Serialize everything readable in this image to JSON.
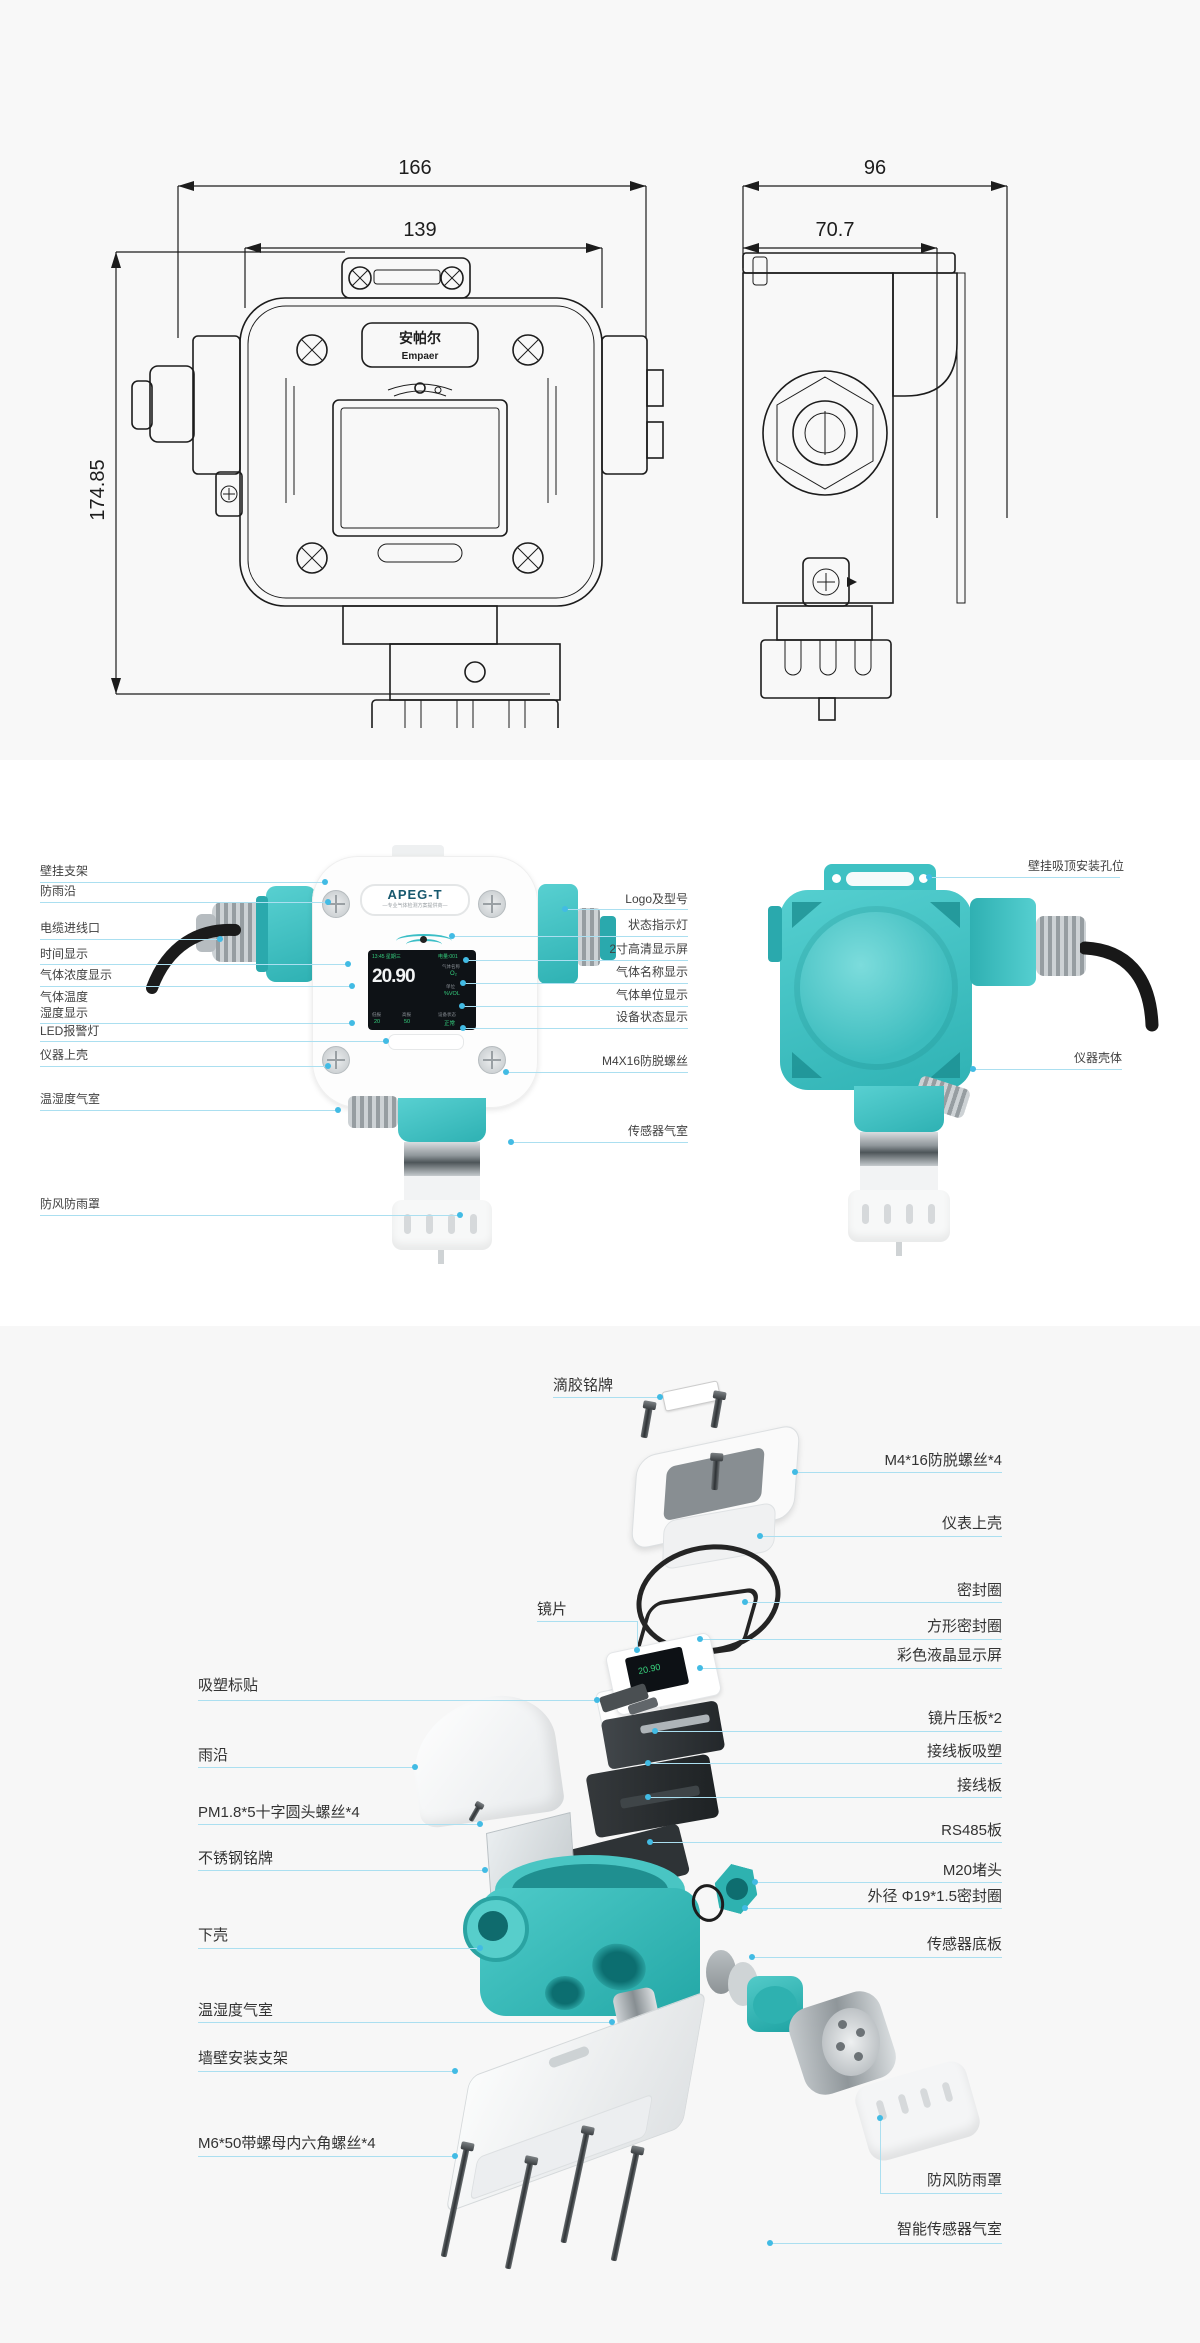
{
  "tech": {
    "front": {
      "dim_outer": "166",
      "dim_inner": "139",
      "dim_height": "174.85",
      "brand_cn": "安帕尔",
      "brand_en": "Empaer"
    },
    "side": {
      "dim_outer": "96",
      "dim_inner": "70.7"
    }
  },
  "device": {
    "logo": "APEG-T",
    "tagline": "—专业气体检测方案提供商—",
    "screen": {
      "time": "13:45 星期三",
      "battery": "电量:001",
      "value": "20.90",
      "gas_label": "气体名称",
      "gas": "O₂",
      "unit_label": "单位",
      "unit": "%VOL",
      "status_label": "设备状态",
      "status": "正常",
      "low_label": "低报",
      "low": "20",
      "high_label": "高报",
      "high": "50"
    },
    "mini_value": "20.90"
  },
  "c2": {
    "left": [
      "壁挂支架",
      "防雨沿",
      "电缆进线口",
      "时间显示",
      "气体浓度显示",
      "气体温度",
      "湿度显示",
      "LED报警灯",
      "仪器上壳",
      "温湿度气室",
      "防风防雨罩"
    ],
    "center": [
      "Logo及型号",
      "状态指示灯",
      "2寸高清显示屏",
      "气体名称显示",
      "气体单位显示",
      "设备状态显示",
      "M4X16防脱螺丝",
      "传感器气室"
    ],
    "right": [
      "壁挂吸顶安装孔位",
      "仪器壳体"
    ]
  },
  "c3": {
    "left": [
      "滴胶铭牌",
      "镜片",
      "吸塑标贴",
      "雨沿",
      "PM1.8*5十字圆头螺丝*4",
      "不锈钢铭牌",
      "下壳",
      "温湿度气室",
      "墙壁安装支架",
      "M6*50带螺母内六角螺丝*4"
    ],
    "right": [
      "M4*16防脱螺丝*4",
      "仪表上壳",
      "密封圈",
      "方形密封圈",
      "彩色液晶显示屏",
      "镜片压板*2",
      "接线板吸塑",
      "接线板",
      "RS485板",
      "M20堵头",
      "外径 Φ19*1.5密封圈",
      "传感器底板",
      "防风防雨罩",
      "智能传感器气室"
    ]
  },
  "colors": {
    "teal": "#3ec1c3",
    "callout_line": "#abdff0",
    "callout_dot": "#42bbe4",
    "section_bg": "#f8f8f8",
    "screen_green": "#35d07f"
  }
}
